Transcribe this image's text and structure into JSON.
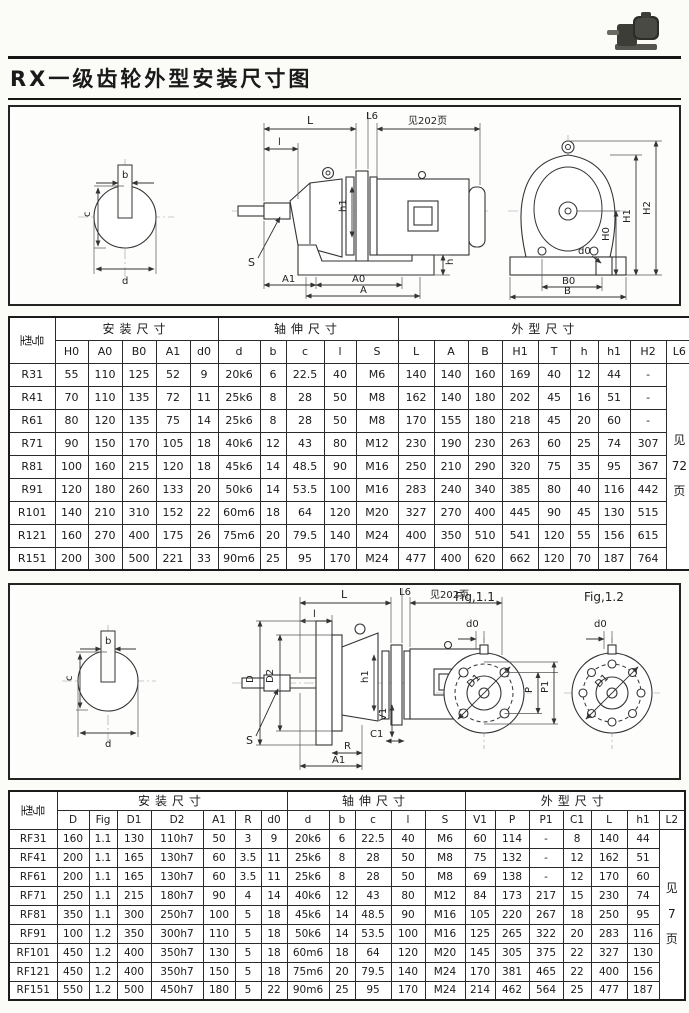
{
  "header": {
    "title": "RX一级齿轮外型安装尺寸图",
    "photo_icon": "gearmotor-photo"
  },
  "diagram1": {
    "section": {
      "b": "b",
      "c": "c",
      "d": "d"
    },
    "side": {
      "L": "L",
      "L6": "L6",
      "see_page": "见202页",
      "l": "l",
      "h1": "h1",
      "S": "S",
      "h": "h",
      "A1": "A1",
      "A0": "A0",
      "A": "A"
    },
    "end": {
      "H1": "H1",
      "H2": "H2",
      "H0": "H0",
      "d0": "d0",
      "B0": "B0",
      "B": "B"
    }
  },
  "table1": {
    "corner": "型号",
    "groups": [
      {
        "label": "安装尺寸",
        "span": 5
      },
      {
        "label": "轴伸尺寸",
        "span": 5
      },
      {
        "label": "外型尺寸",
        "span": 9
      }
    ],
    "columns": [
      "H0",
      "A0",
      "B0",
      "A1",
      "d0",
      "d",
      "b",
      "c",
      "l",
      "S",
      "L",
      "A",
      "B",
      "H1",
      "T",
      "h",
      "h1",
      "H2",
      "L6"
    ],
    "note": [
      "见",
      "72",
      "页"
    ],
    "rows": [
      {
        "model": "R31",
        "values": [
          "55",
          "110",
          "125",
          "52",
          "9",
          "20k6",
          "6",
          "22.5",
          "40",
          "M6",
          "140",
          "140",
          "160",
          "169",
          "40",
          "12",
          "44",
          "-"
        ]
      },
      {
        "model": "R41",
        "values": [
          "70",
          "110",
          "135",
          "72",
          "11",
          "25k6",
          "8",
          "28",
          "50",
          "M8",
          "162",
          "140",
          "180",
          "202",
          "45",
          "16",
          "51",
          "-"
        ]
      },
      {
        "model": "R61",
        "values": [
          "80",
          "120",
          "135",
          "75",
          "14",
          "25k6",
          "8",
          "28",
          "50",
          "M8",
          "170",
          "155",
          "180",
          "218",
          "45",
          "20",
          "60",
          "-"
        ]
      },
      {
        "model": "R71",
        "values": [
          "90",
          "150",
          "170",
          "105",
          "18",
          "40k6",
          "12",
          "43",
          "80",
          "M12",
          "230",
          "190",
          "230",
          "263",
          "60",
          "25",
          "74",
          "307"
        ]
      },
      {
        "model": "R81",
        "values": [
          "100",
          "160",
          "215",
          "120",
          "18",
          "45k6",
          "14",
          "48.5",
          "90",
          "M16",
          "250",
          "210",
          "290",
          "320",
          "75",
          "35",
          "95",
          "367"
        ]
      },
      {
        "model": "R91",
        "values": [
          "120",
          "180",
          "260",
          "133",
          "20",
          "50k6",
          "14",
          "53.5",
          "100",
          "M16",
          "283",
          "240",
          "340",
          "385",
          "80",
          "40",
          "116",
          "442"
        ]
      },
      {
        "model": "R101",
        "values": [
          "140",
          "210",
          "310",
          "152",
          "22",
          "60m6",
          "18",
          "64",
          "120",
          "M20",
          "327",
          "270",
          "400",
          "445",
          "90",
          "45",
          "130",
          "515"
        ]
      },
      {
        "model": "R121",
        "values": [
          "160",
          "270",
          "400",
          "175",
          "26",
          "75m6",
          "20",
          "79.5",
          "140",
          "M24",
          "400",
          "350",
          "510",
          "541",
          "120",
          "55",
          "156",
          "615"
        ]
      },
      {
        "model": "R151",
        "values": [
          "200",
          "300",
          "500",
          "221",
          "33",
          "90m6",
          "25",
          "95",
          "170",
          "M24",
          "477",
          "400",
          "620",
          "662",
          "120",
          "70",
          "187",
          "764"
        ]
      }
    ]
  },
  "diagram2": {
    "section": {
      "b": "b",
      "c": "c",
      "d": "d"
    },
    "side": {
      "L": "L",
      "L6": "L6",
      "see_page": "见202页",
      "l": "l",
      "D": "D",
      "D2": "D2",
      "h1": "h1",
      "V1": "V1",
      "C1": "C1",
      "R": "R",
      "A1": "A1",
      "S": "S"
    },
    "fig1": {
      "caption": "Fig,1.1",
      "d0": "d0",
      "P": "P",
      "P1": "P1",
      "D1": "D1"
    },
    "fig2": {
      "caption": "Fig,1.2",
      "d0": "d0",
      "D1": "D1"
    }
  },
  "table2": {
    "corner": "型号",
    "groups": [
      {
        "label": "安装尺寸",
        "span": 7
      },
      {
        "label": "轴伸尺寸",
        "span": 5
      },
      {
        "label": "外型尺寸",
        "span": 7
      }
    ],
    "columns": [
      "D",
      "Fig",
      "D1",
      "D2",
      "A1",
      "R",
      "d0",
      "d",
      "b",
      "c",
      "l",
      "S",
      "V1",
      "P",
      "P1",
      "C1",
      "L",
      "h1",
      "L2"
    ],
    "note": [
      "见",
      "7",
      "页"
    ],
    "rows": [
      {
        "model": "RF31",
        "values": [
          "160",
          "1.1",
          "130",
          "110h7",
          "50",
          "3",
          "9",
          "20k6",
          "6",
          "22.5",
          "40",
          "M6",
          "60",
          "114",
          "-",
          "8",
          "140",
          "44"
        ]
      },
      {
        "model": "RF41",
        "values": [
          "200",
          "1.1",
          "165",
          "130h7",
          "60",
          "3.5",
          "11",
          "25k6",
          "8",
          "28",
          "50",
          "M8",
          "75",
          "132",
          "-",
          "12",
          "162",
          "51"
        ]
      },
      {
        "model": "RF61",
        "values": [
          "200",
          "1.1",
          "165",
          "130h7",
          "60",
          "3.5",
          "11",
          "25k6",
          "8",
          "28",
          "50",
          "M8",
          "69",
          "138",
          "-",
          "12",
          "170",
          "60"
        ]
      },
      {
        "model": "RF71",
        "values": [
          "250",
          "1.1",
          "215",
          "180h7",
          "90",
          "4",
          "14",
          "40k6",
          "12",
          "43",
          "80",
          "M12",
          "84",
          "173",
          "217",
          "15",
          "230",
          "74"
        ]
      },
      {
        "model": "RF81",
        "values": [
          "350",
          "1.1",
          "300",
          "250h7",
          "100",
          "5",
          "18",
          "45k6",
          "14",
          "48.5",
          "90",
          "M16",
          "105",
          "220",
          "267",
          "18",
          "250",
          "95"
        ]
      },
      {
        "model": "RF91",
        "values": [
          "100",
          "1.2",
          "350",
          "300h7",
          "110",
          "5",
          "18",
          "50k6",
          "14",
          "53.5",
          "100",
          "M16",
          "125",
          "265",
          "322",
          "20",
          "283",
          "116"
        ]
      },
      {
        "model": "RF101",
        "values": [
          "450",
          "1.2",
          "400",
          "350h7",
          "130",
          "5",
          "18",
          "60m6",
          "18",
          "64",
          "120",
          "M20",
          "145",
          "305",
          "375",
          "22",
          "327",
          "130"
        ]
      },
      {
        "model": "RF121",
        "values": [
          "450",
          "1.2",
          "400",
          "350h7",
          "150",
          "5",
          "18",
          "75m6",
          "20",
          "79.5",
          "140",
          "M24",
          "170",
          "381",
          "465",
          "22",
          "400",
          "156"
        ]
      },
      {
        "model": "RF151",
        "values": [
          "550",
          "1.2",
          "500",
          "450h7",
          "180",
          "5",
          "22",
          "90m6",
          "25",
          "95",
          "170",
          "M24",
          "214",
          "462",
          "564",
          "25",
          "477",
          "187"
        ]
      }
    ]
  }
}
